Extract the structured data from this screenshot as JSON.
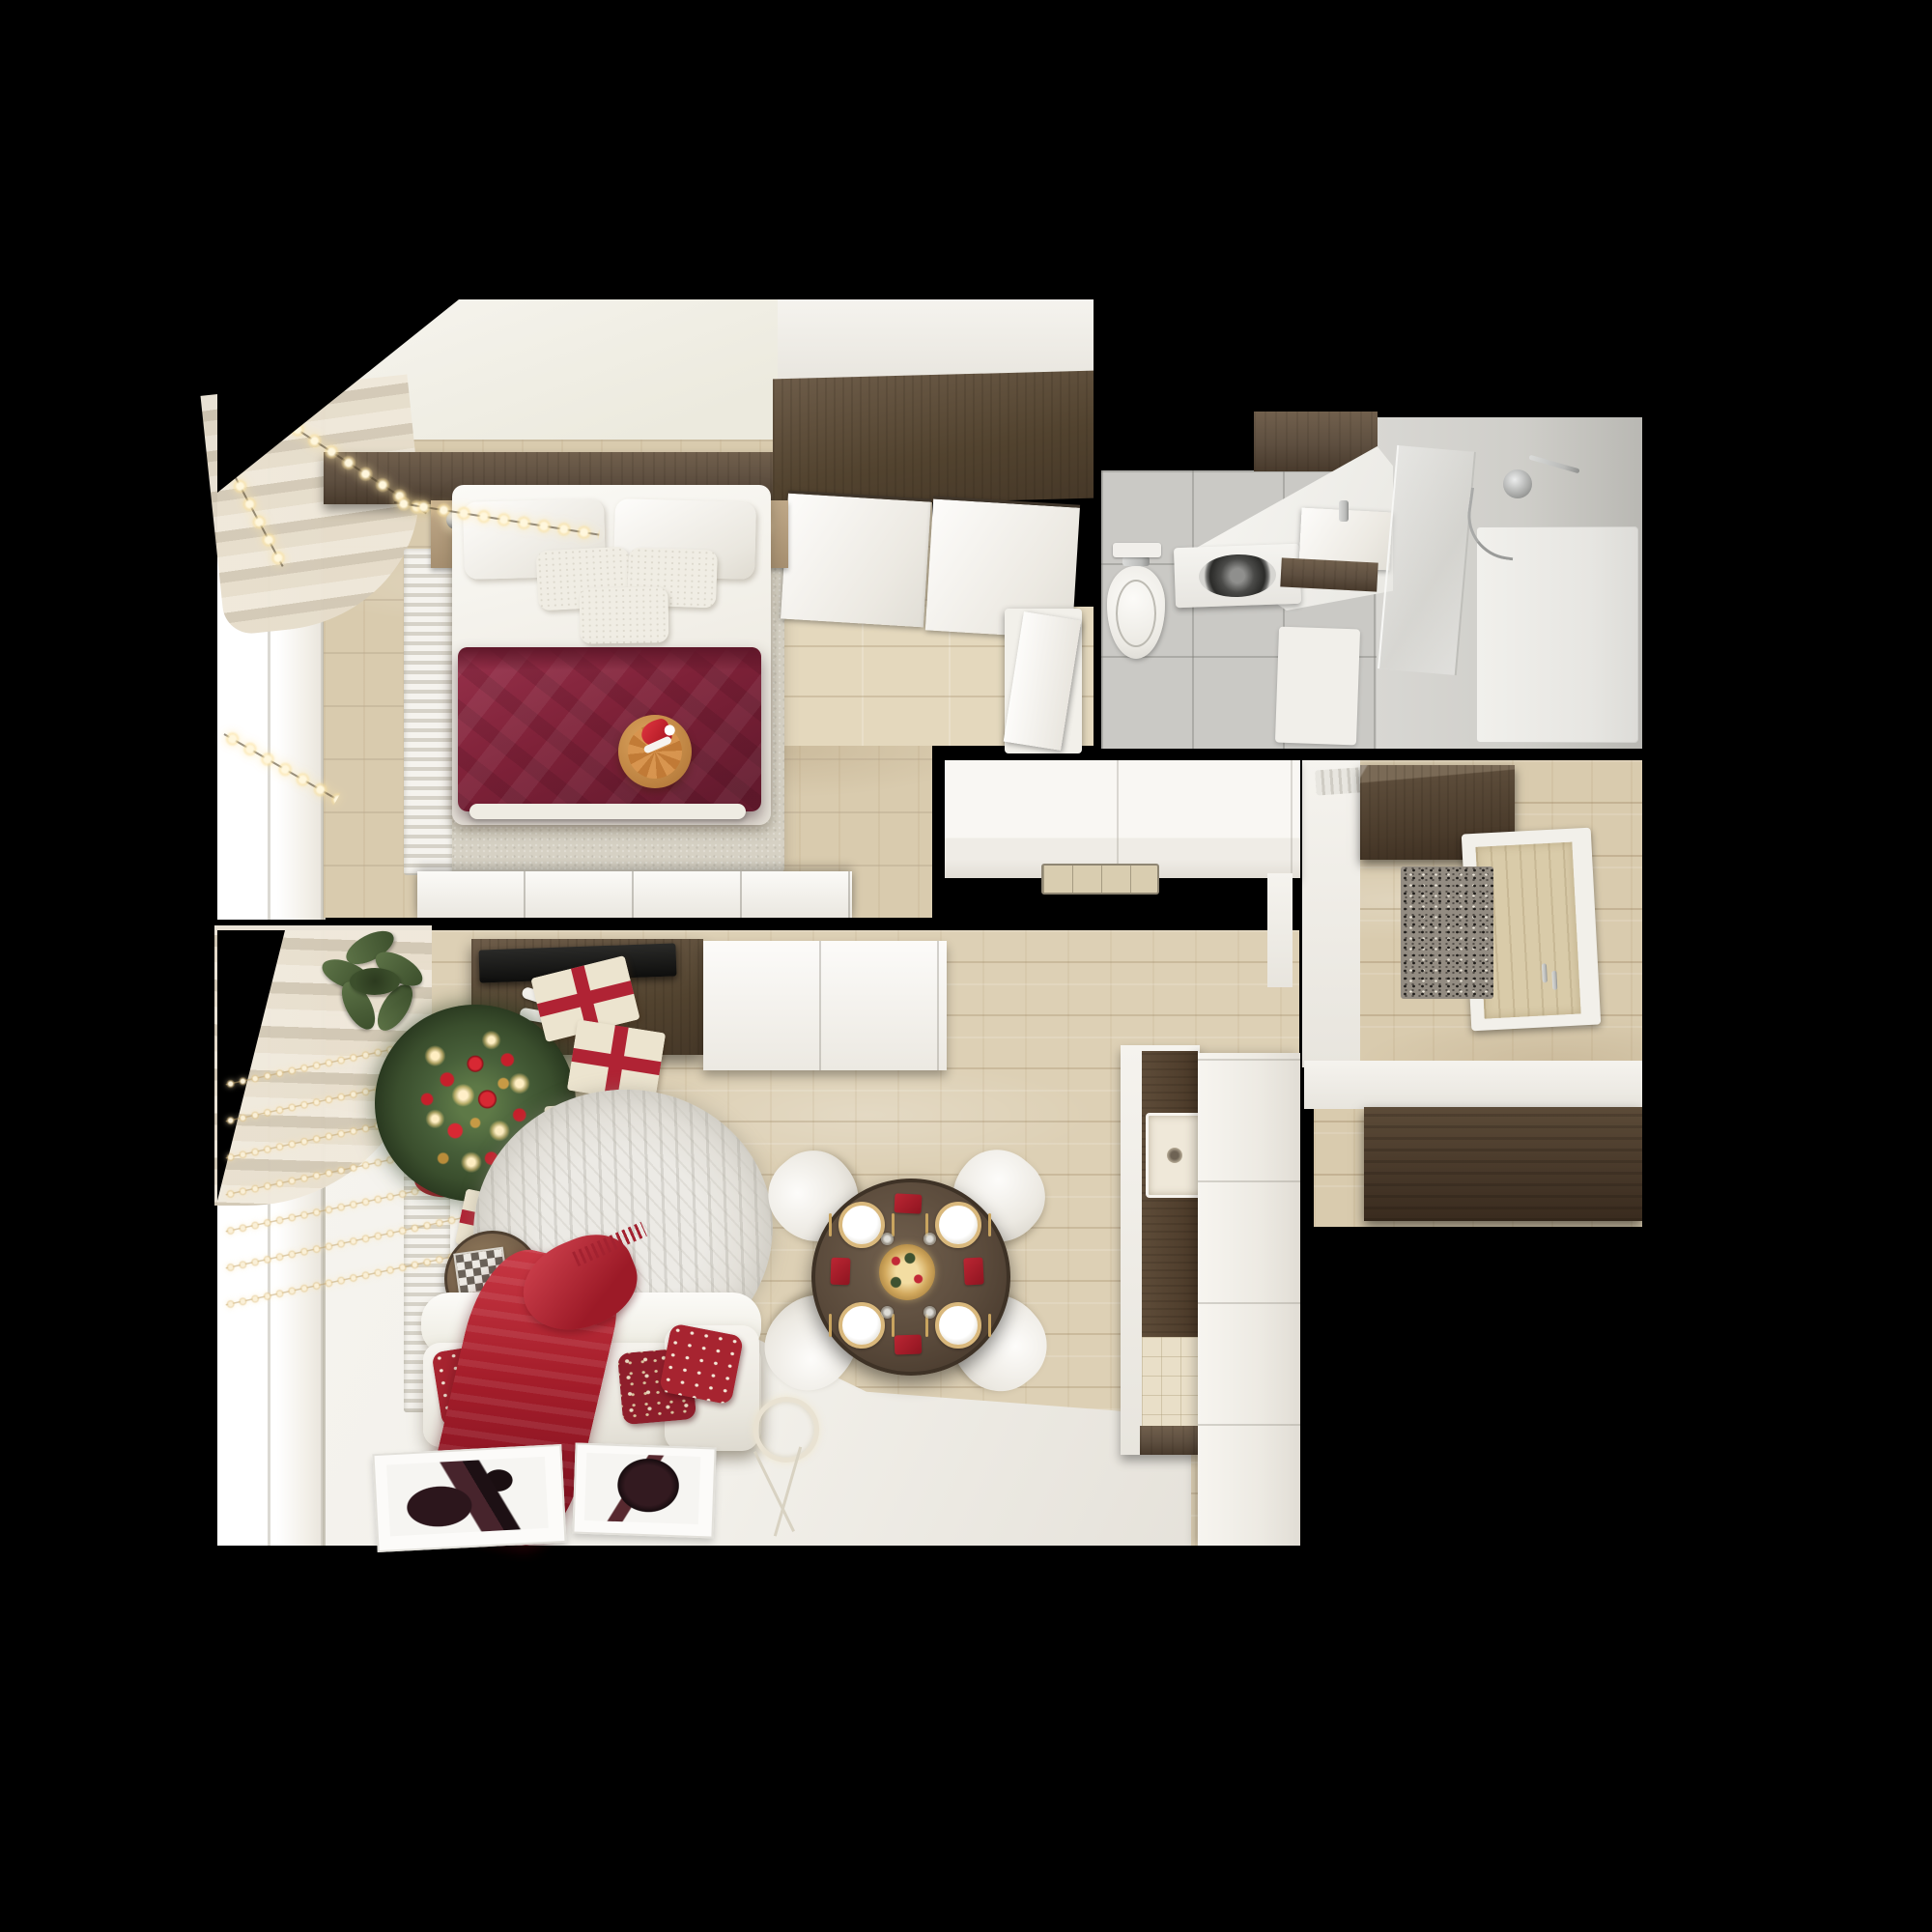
{
  "scene": {
    "type": "photorealistic-3d-render",
    "view": "top-down floor plan of a small apartment with christmas decorations",
    "background": "black",
    "rooms": [
      {
        "name": "bedroom",
        "objects": [
          "window-with-fairy-lights",
          "curtain",
          "radiator",
          "headboard-shelf",
          "bedside-lamps",
          "double-bed",
          "white-pillows",
          "burgundy-duvet",
          "wood-tray-with-cat-and-santa-hat",
          "gray-rug",
          "wardrobe-with-sliding-doors",
          "white-sideboard",
          "door"
        ]
      },
      {
        "name": "bathroom",
        "objects": [
          "gray-tile-floor",
          "dark-wood-cabinet",
          "vanity-counter",
          "washing-machine",
          "toilet",
          "sink-with-faucet",
          "light-switch",
          "glass-shower-screen",
          "shower-head",
          "shower-tray",
          "bath-mat"
        ]
      },
      {
        "name": "hallway",
        "objects": [
          "wood-floor",
          "ceiling-vent",
          "dark-wood-wardrobe",
          "entry-door-with-handles",
          "speckled-doormat",
          "white-step",
          "dark-wood-bench"
        ]
      },
      {
        "name": "kitchen",
        "objects": [
          "white-counter",
          "built-in-cooktop",
          "side-panel",
          "column-with-dark-wood-front",
          "square-sink",
          "beige-tile-patch",
          "tall-white-unit"
        ]
      },
      {
        "name": "dining-area",
        "objects": [
          "round-dark-wood-table",
          "four-white-chairs",
          "gold-rimmed-plates",
          "red-napkins",
          "gold-cutlery",
          "gold-wreath-centerpiece",
          "glasses"
        ]
      },
      {
        "name": "living-room",
        "objects": [
          "window-with-bead-light-curtain",
          "beige-curtain",
          "radiator",
          "tv-console",
          "flat-tv",
          "remote-controls",
          "white-cabinet",
          "potted-plant",
          "christmas-tree-with-ornaments",
          "red-tree-skirt",
          "gift-boxes-with-red-ribbon",
          "round-shaggy-rug",
          "round-coffee-table",
          "chessboard",
          "white-sofa",
          "holiday-pillows",
          "red-throw-blanket",
          "ring-floor-lamp",
          "two-framed-posters-on-floor",
          "white-floor-area"
        ]
      }
    ]
  },
  "palette": {
    "bg": "#000000",
    "floor_wood": "#d9cbae",
    "floor_wood_living": "#ddd0b5",
    "floor_white": "#f2f0ea",
    "wall_white": "#f5f3ee",
    "dark_wood": "#5e4f40",
    "dark_wood_deep": "#463828",
    "burgundy": "#7e2138",
    "red": "#b02334",
    "tree_green": "#3a4e2d",
    "gold": "#d9b87c",
    "tile_gray": "#cac9c5",
    "shower_gray": "#cfcec9",
    "rug_gray": "#d6d1c4",
    "marble_rug": "#eceae5",
    "sofa_white": "#f7f5f0",
    "door_beige": "#d9cba9",
    "sink_beige": "#efe8d9",
    "chrome": "#b9bab8"
  }
}
